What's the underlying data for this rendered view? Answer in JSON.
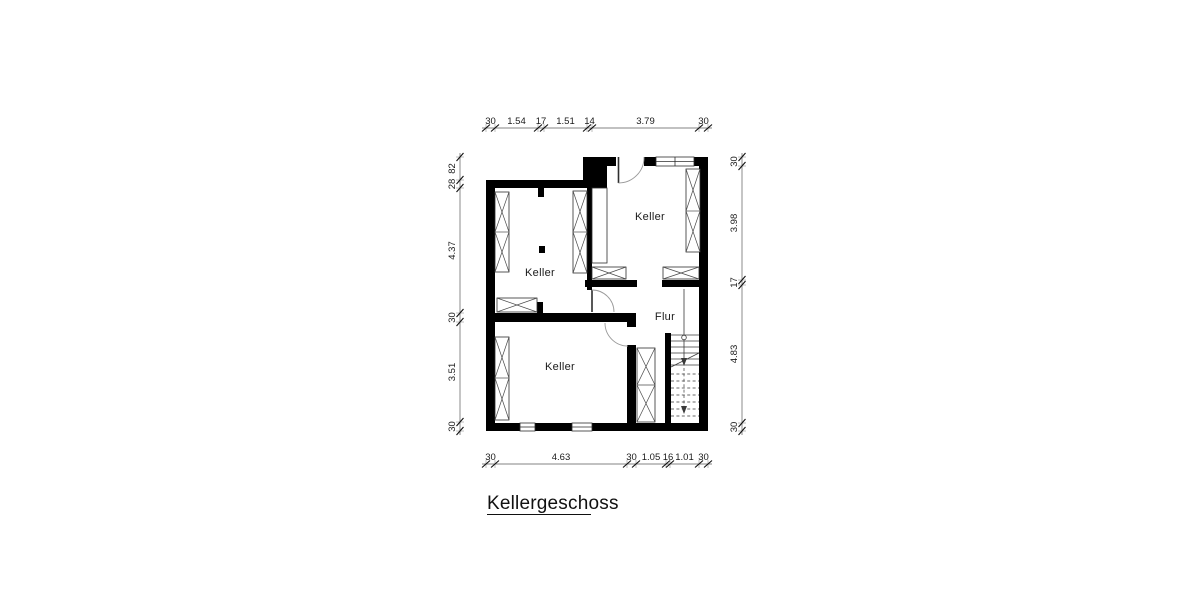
{
  "drawing": {
    "title": "Kellergeschoss",
    "rooms": [
      {
        "label": "Keller"
      },
      {
        "label": "Keller"
      },
      {
        "label": "Keller"
      },
      {
        "label": "Flur"
      }
    ],
    "dimensions": {
      "top": [
        "30",
        "1.54",
        "17",
        "1.51",
        "14",
        "3.79",
        "30"
      ],
      "bottom": [
        "30",
        "4.63",
        "30",
        "1.05",
        "16",
        "1.01",
        "30"
      ],
      "left": [
        "82",
        "28",
        "4.37",
        "30",
        "3.51",
        "30"
      ],
      "right": [
        "30",
        "3.98",
        "17",
        "4.83",
        "30"
      ]
    },
    "colors": {
      "background": "#ffffff",
      "wall": "#000000",
      "dimension": "#1a1a1a"
    }
  }
}
